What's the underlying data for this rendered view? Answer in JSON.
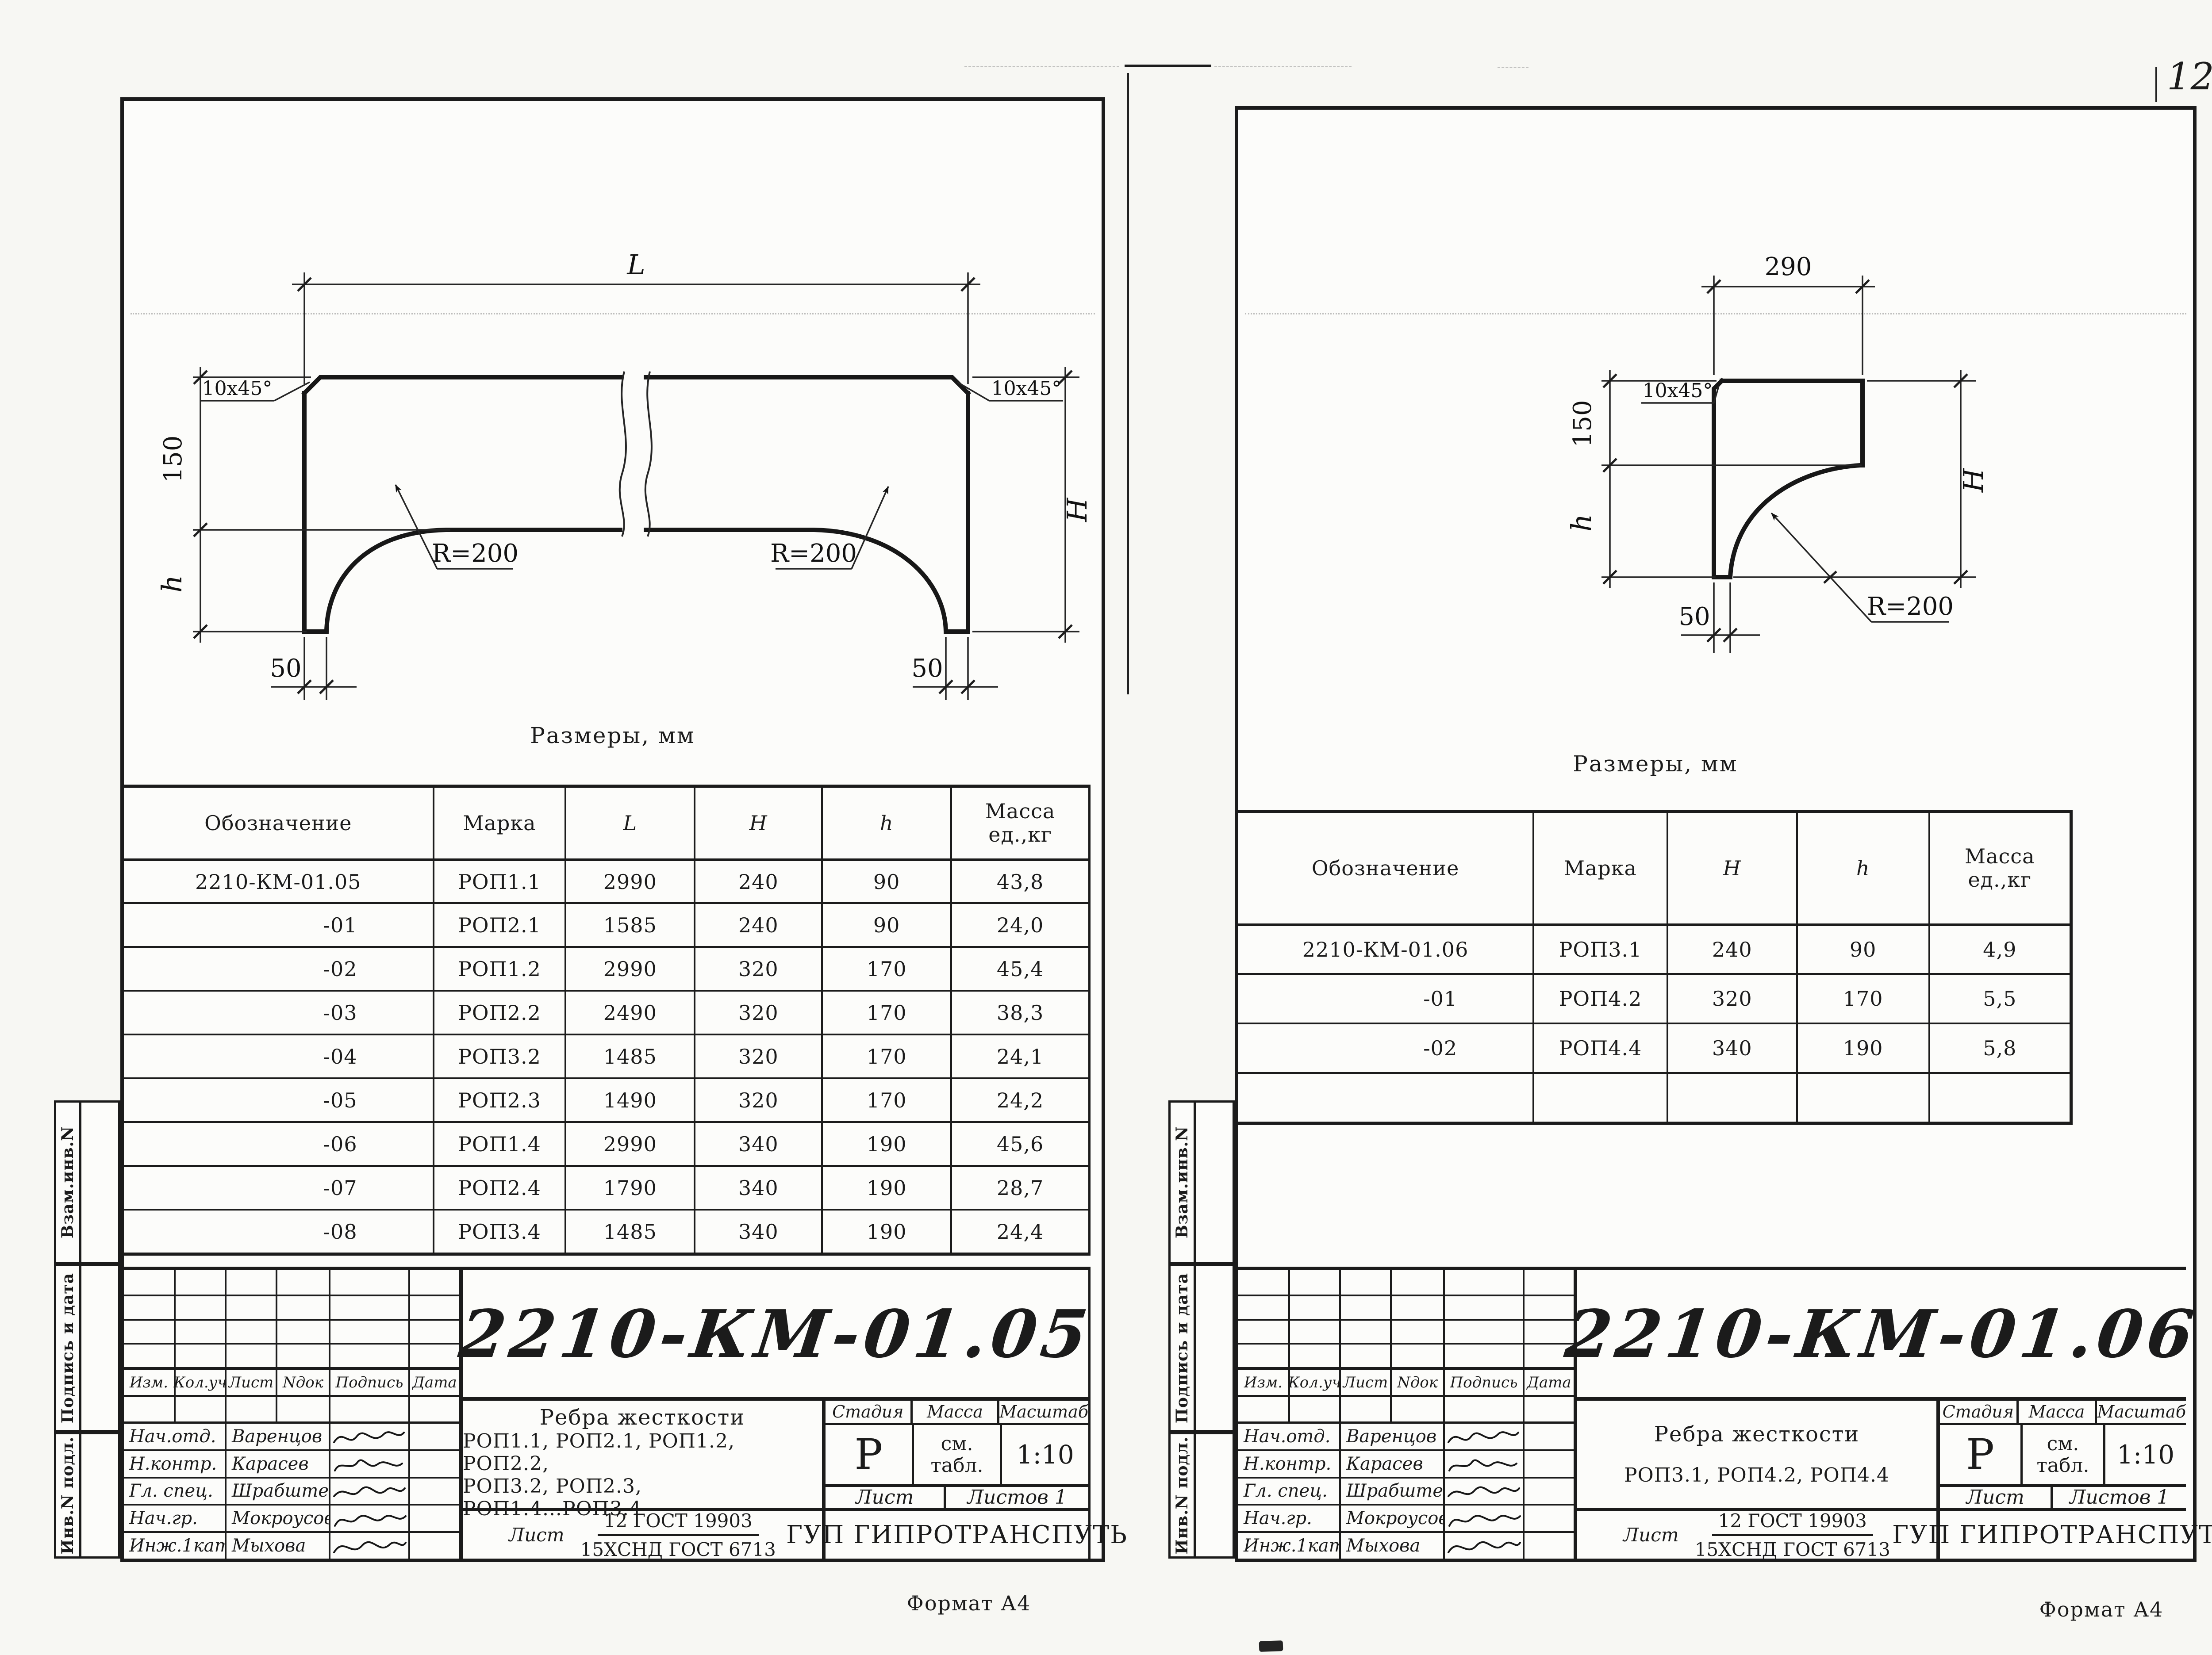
{
  "page": {
    "number": "12",
    "format": "Формат А4"
  },
  "strip": [
    "Взам.инв.N",
    "Подпись и дата",
    "Инв.N подл."
  ],
  "tb_common": {
    "stage_h": "Стадия",
    "mass_h": "Масса",
    "scale_h": "Масштаб",
    "stage": "Р",
    "mass_a": "см.",
    "mass_b": "табл.",
    "scale": "1:10",
    "sheet_h": "Лист",
    "sheets_h": "Листов 1",
    "mat_sheet": "Лист",
    "mat_top": "12 ГОСТ 19903",
    "mat_bottom": "15ХСНД ГОСТ 6713",
    "company": "ГУП ГИПРОТРАНСПУТЬ",
    "rev": [
      "Изм.",
      "Кол.уч",
      "Лист",
      "Nдок",
      "Подпись",
      "Дата"
    ],
    "people": [
      {
        "role": "Нач.отд.",
        "name": "Варенцов"
      },
      {
        "role": "Н.контр.",
        "name": "Карасев"
      },
      {
        "role": "Гл. спец.",
        "name": "Шрабштейн"
      },
      {
        "role": "Нач.гр.",
        "name": "Мокроусова"
      },
      {
        "role": "Инж.1кат",
        "name": "Мыхова"
      }
    ]
  },
  "left": {
    "caption": "Размеры, мм",
    "drawing": {
      "length": "L",
      "upper": "150",
      "lower": "h",
      "total": "H",
      "foot": "50",
      "foot2": "50",
      "radius": "R=200",
      "radius2": "R=200",
      "chamfer": "10x45°",
      "chamfer2": "10x45°"
    },
    "table": {
      "col_d": "Обозначение",
      "col_m": "Марка",
      "col_L": "L",
      "col_H": "H",
      "col_h": "h",
      "col_w1": "Масса",
      "col_w2": "ед.,кг",
      "rows": [
        [
          "2210-КМ-01.05",
          "РОП1.1",
          "2990",
          "240",
          "90",
          "43,8"
        ],
        [
          "-01",
          "РОП2.1",
          "1585",
          "240",
          "90",
          "24,0"
        ],
        [
          "-02",
          "РОП1.2",
          "2990",
          "320",
          "170",
          "45,4"
        ],
        [
          "-03",
          "РОП2.2",
          "2490",
          "320",
          "170",
          "38,3"
        ],
        [
          "-04",
          "РОП3.2",
          "1485",
          "320",
          "170",
          "24,1"
        ],
        [
          "-05",
          "РОП2.3",
          "1490",
          "320",
          "170",
          "24,2"
        ],
        [
          "-06",
          "РОП1.4",
          "2990",
          "340",
          "190",
          "45,6"
        ],
        [
          "-07",
          "РОП2.4",
          "1790",
          "340",
          "190",
          "28,7"
        ],
        [
          "-08",
          "РОП3.4",
          "1485",
          "340",
          "190",
          "24,4"
        ]
      ]
    },
    "tb": {
      "number": "2210-КМ-01.05",
      "name1": "Ребра жесткости",
      "name2": "РОП1.1, РОП2.1, РОП1.2, РОП2.2,",
      "name3": "РОП3.2, РОП2.3, РОП1.4...РОП3.4"
    }
  },
  "right": {
    "caption": "Размеры, мм",
    "drawing": {
      "width": "290",
      "upper": "150",
      "lower": "h",
      "total": "H",
      "foot": "50",
      "radius": "R=200",
      "chamfer": "10x45°"
    },
    "table": {
      "col_d": "Обозначение",
      "col_m": "Марка",
      "col_H": "H",
      "col_h": "h",
      "col_w1": "Масса",
      "col_w2": "ед.,кг",
      "rows": [
        [
          "2210-КМ-01.06",
          "РОП3.1",
          "240",
          "90",
          "4,9"
        ],
        [
          "-01",
          "РОП4.2",
          "320",
          "170",
          "5,5"
        ],
        [
          "-02",
          "РОП4.4",
          "340",
          "190",
          "5,8"
        ]
      ]
    },
    "tb": {
      "number": "2210-КМ-01.06",
      "name1": "Ребра жесткости",
      "name2": "РОП3.1, РОП4.2, РОП4.4"
    }
  }
}
